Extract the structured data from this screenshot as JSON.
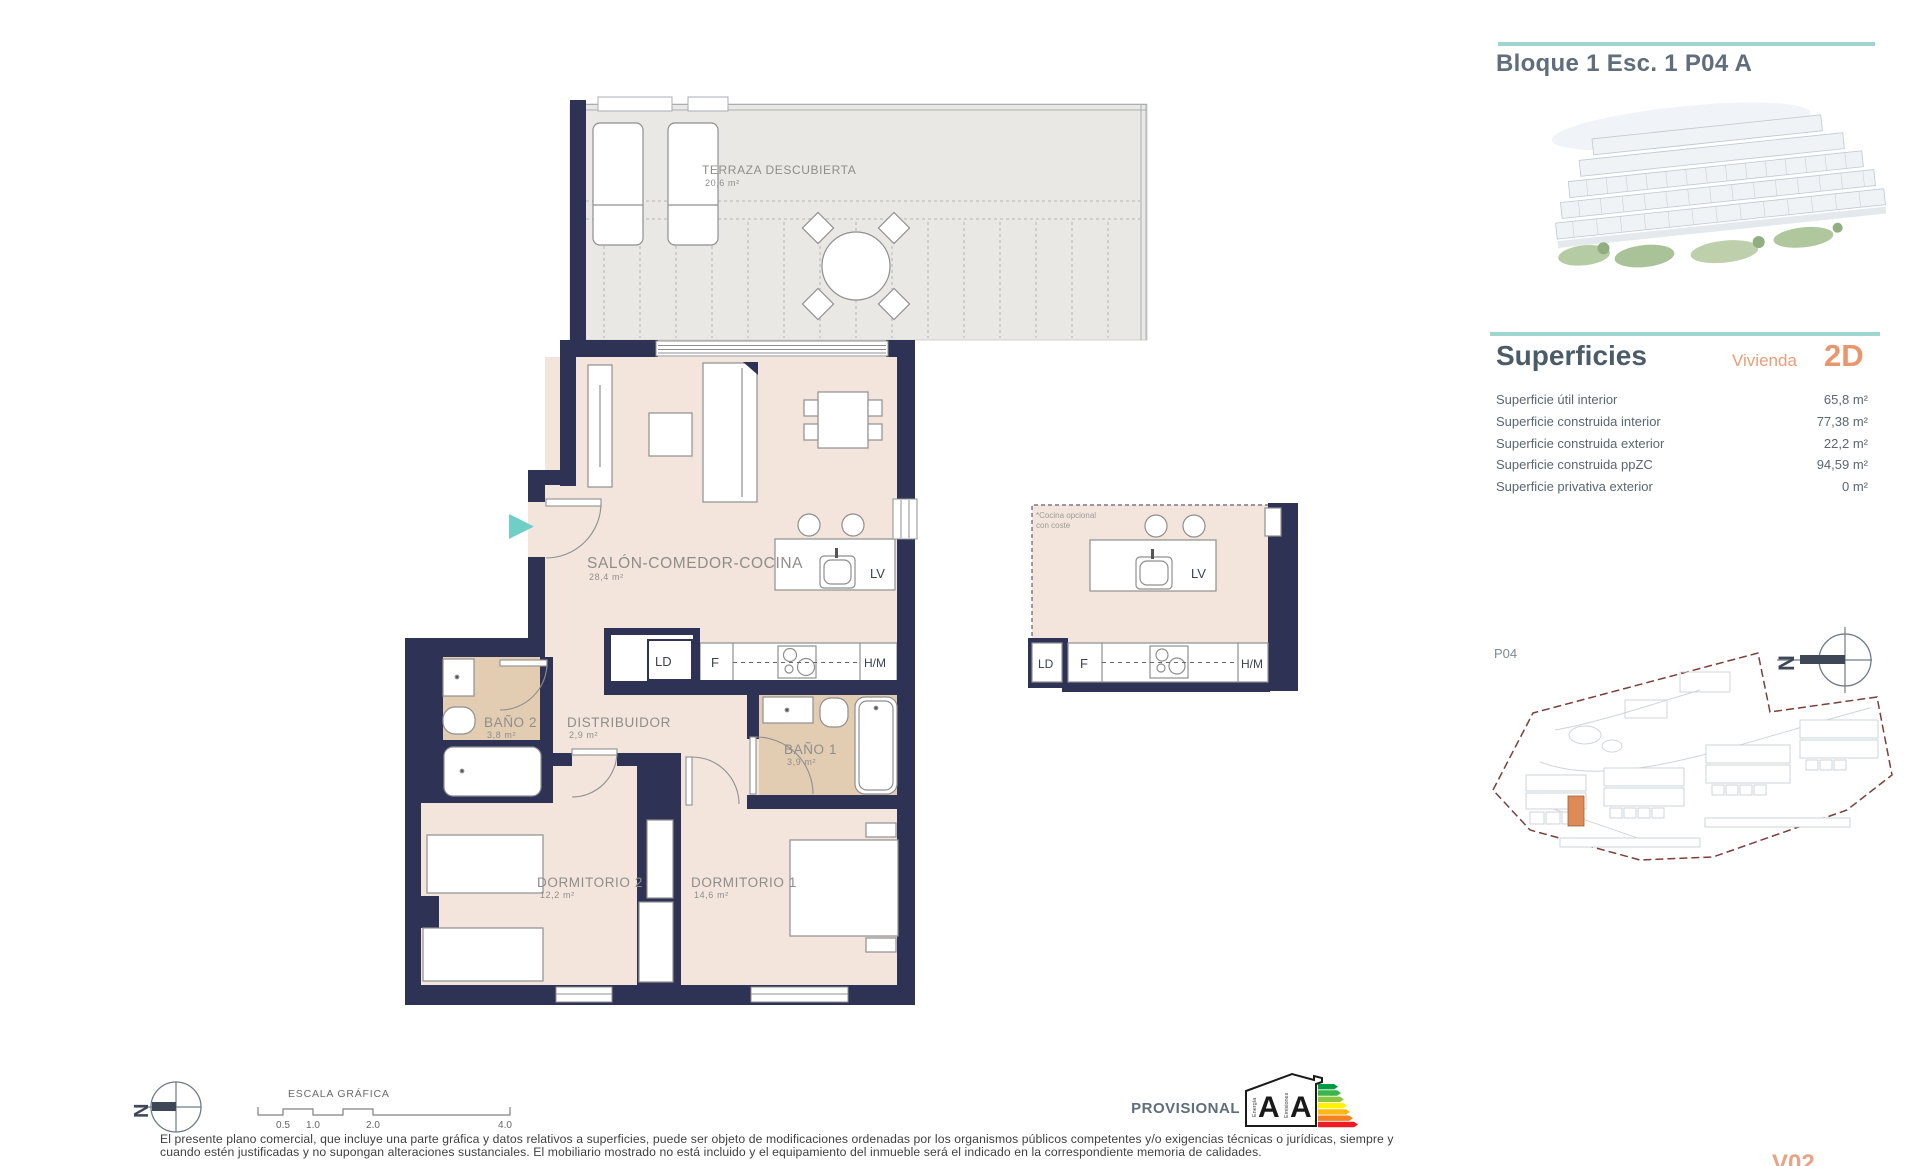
{
  "header": {
    "title": "Bloque 1 Esc. 1 P04 A"
  },
  "superficies": {
    "heading": "Superficies",
    "vivienda_label": "Vivienda",
    "vivienda_code": "2D",
    "rows": [
      {
        "label": "Superficie útil interior",
        "value": "65,8 m²"
      },
      {
        "label": "Superficie construida interior",
        "value": "77,38 m²"
      },
      {
        "label": "Superficie construida exterior",
        "value": "22,2 m²"
      },
      {
        "label": "Superficie construida ppZC",
        "value": "94,59 m²"
      },
      {
        "label": "Superficie privativa exterior",
        "value": "0 m²"
      }
    ]
  },
  "floor_plan": {
    "rooms": [
      {
        "name": "TERRAZA DESCUBIERTA",
        "area": "20,6 m²"
      },
      {
        "name": "SALÓN-COMEDOR-COCINA",
        "area": "28,4 m²"
      },
      {
        "name": "BAÑO 2",
        "area": "3,8 m²"
      },
      {
        "name": "DISTRIBUIDOR",
        "area": "2,9 m²"
      },
      {
        "name": "BAÑO 1",
        "area": "3,9 m²"
      },
      {
        "name": "DORMITORIO 2",
        "area": "12,2 m²"
      },
      {
        "name": "DORMITORIO 1",
        "area": "14,6 m²"
      }
    ],
    "appliances": {
      "lv": "LV",
      "ld": "LD",
      "f": "F",
      "hm": "H/M"
    }
  },
  "kitchen_detail": {
    "note_line1": "*Cocina opcional",
    "note_line2": "con coste"
  },
  "site_plan": {
    "floor_label": "P04",
    "north_letter": "N"
  },
  "scale_bar": {
    "title": "ESCALA GRÁFICA",
    "ticks": [
      "0.5",
      "1.0",
      "2.0",
      "4.0"
    ]
  },
  "energy_label": {
    "energy_letter": "A",
    "emissions_letter": "A",
    "energy_text": "Energía",
    "emissions_text": "Emisiones"
  },
  "footer": {
    "provisional": "PROVISIONAL",
    "disclaimer_line1": "El presente plano comercial, que incluye una parte gráfica y datos relativos a superficies, puede ser objeto de modificaciones ordenadas por los organismos públicos competentes y/o exigencias técnicas o jurídicas, siempre y",
    "disclaimer_line2": "cuando estén justificadas y no supongan alteraciones sustanciales. El mobiliario mostrado no está incluido y el equipamiento del inmueble será el indicado en la correspondiente memoria de calidades.",
    "version": "V02"
  },
  "colors": {
    "wall_navy": "#2e3355",
    "accent_teal": "#9ed6cf",
    "entrance_arrow_teal": "#6fcfc7",
    "orange_accent": "#e9956d",
    "floor_pink": "#f3e5dc",
    "floor_tan": "#e3cdb2",
    "terrace_gray": "#e9e8e5",
    "site_boundary_red": "#7a4038",
    "site_highlight_orange": "#dd8a57"
  }
}
